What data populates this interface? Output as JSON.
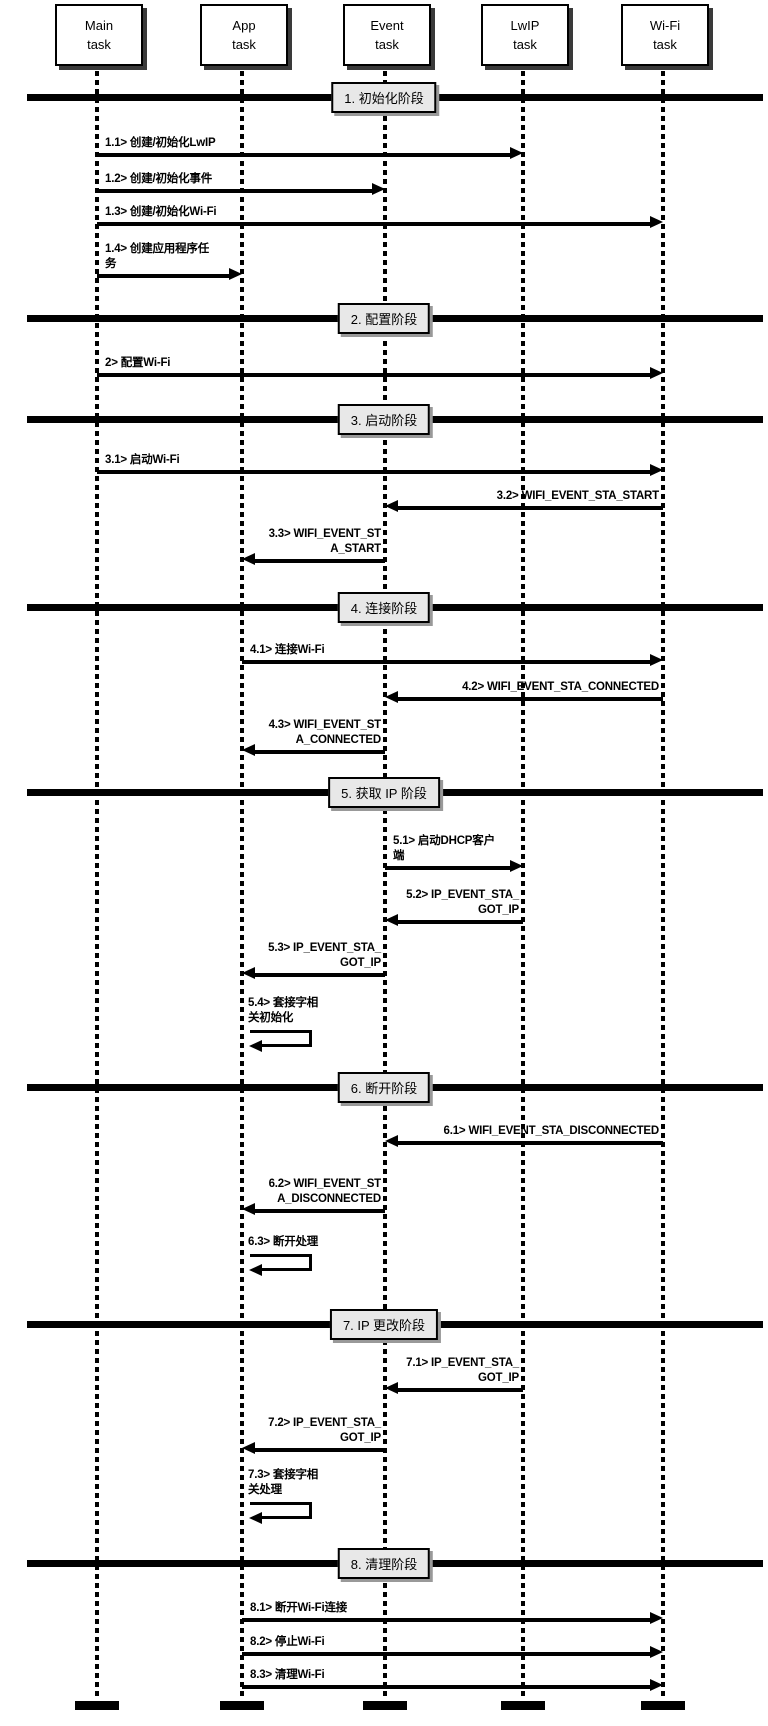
{
  "diagram": {
    "type": "sequence-diagram",
    "colors": {
      "background": "#ffffff",
      "line": "#000000",
      "divider_label_fill": "#e8e8e8",
      "box_shadow": "#3a3a3a"
    },
    "actors": [
      {
        "id": "main",
        "label": "Main\ntask",
        "x": 97
      },
      {
        "id": "app",
        "label": "App\ntask",
        "x": 242
      },
      {
        "id": "event",
        "label": "Event\ntask",
        "x": 385
      },
      {
        "id": "lwip",
        "label": "LwIP\ntask",
        "x": 523
      },
      {
        "id": "wifi",
        "label": "Wi-Fi\ntask",
        "x": 663
      }
    ],
    "phases": [
      {
        "number": 1,
        "label": "1. 初始化阶段",
        "y": 97
      },
      {
        "number": 2,
        "label": "2. 配置阶段",
        "y": 318
      },
      {
        "number": 3,
        "label": "3. 启动阶段",
        "y": 419
      },
      {
        "number": 4,
        "label": "4. 连接阶段",
        "y": 607
      },
      {
        "number": 5,
        "label": "5. 获取 IP 阶段",
        "y": 792
      },
      {
        "number": 6,
        "label": "6. 断开阶段",
        "y": 1087
      },
      {
        "number": 7,
        "label": "7. IP 更改阶段",
        "y": 1324
      },
      {
        "number": 8,
        "label": "8. 清理阶段",
        "y": 1563
      }
    ],
    "messages": [
      {
        "id": "1.1",
        "lines": [
          "1.1> 创建/初始化LwIP"
        ],
        "from": "main",
        "to": "lwip",
        "y": 155
      },
      {
        "id": "1.2",
        "lines": [
          "1.2> 创建/初始化事件"
        ],
        "from": "main",
        "to": "event",
        "y": 191
      },
      {
        "id": "1.3",
        "lines": [
          "1.3> 创建/初始化Wi-Fi"
        ],
        "from": "main",
        "to": "wifi",
        "y": 224
      },
      {
        "id": "1.4",
        "lines": [
          "1.4> 创建应用程序任",
          "务"
        ],
        "from": "main",
        "to": "app",
        "y": 276
      },
      {
        "id": "2",
        "lines": [
          "2> 配置Wi-Fi"
        ],
        "from": "main",
        "to": "wifi",
        "y": 375
      },
      {
        "id": "3.1",
        "lines": [
          "3.1> 启动Wi-Fi"
        ],
        "from": "main",
        "to": "wifi",
        "y": 472
      },
      {
        "id": "3.2",
        "lines": [
          "3.2> WIFI_EVENT_STA_START"
        ],
        "from": "wifi",
        "to": "event",
        "y": 508
      },
      {
        "id": "3.3",
        "lines": [
          "3.3> WIFI_EVENT_ST",
          "A_START"
        ],
        "from": "event",
        "to": "app",
        "y": 561
      },
      {
        "id": "4.1",
        "lines": [
          "4.1> 连接Wi-Fi"
        ],
        "from": "app",
        "to": "wifi",
        "y": 662
      },
      {
        "id": "4.2",
        "lines": [
          "4.2> WIFI_EVENT_STA_CONNECTED"
        ],
        "from": "wifi",
        "to": "event",
        "y": 699
      },
      {
        "id": "4.3",
        "lines": [
          "4.3> WIFI_EVENT_ST",
          "A_CONNECTED"
        ],
        "from": "event",
        "to": "app",
        "y": 752
      },
      {
        "id": "5.1",
        "lines": [
          "5.1> 启动DHCP客户",
          "端"
        ],
        "from": "event",
        "to": "lwip",
        "y": 868
      },
      {
        "id": "5.2",
        "lines": [
          "5.2> IP_EVENT_STA_",
          "GOT_IP"
        ],
        "from": "lwip",
        "to": "event",
        "y": 922
      },
      {
        "id": "5.3",
        "lines": [
          "5.3> IP_EVENT_STA_",
          "GOT_IP"
        ],
        "from": "event",
        "to": "app",
        "y": 975
      },
      {
        "id": "5.4",
        "lines": [
          "5.4> 套接字相",
          "关初始化"
        ],
        "from": "app",
        "to": "app",
        "self": true,
        "y": 1030
      },
      {
        "id": "6.1",
        "lines": [
          "6.1> WIFI_EVENT_STA_DISCONNECTED"
        ],
        "from": "wifi",
        "to": "event",
        "y": 1143
      },
      {
        "id": "6.2",
        "lines": [
          "6.2> WIFI_EVENT_ST",
          "A_DISCONNECTED"
        ],
        "from": "event",
        "to": "app",
        "y": 1211
      },
      {
        "id": "6.3",
        "lines": [
          "6.3> 断开处理"
        ],
        "from": "app",
        "to": "app",
        "self": true,
        "y": 1254
      },
      {
        "id": "7.1",
        "lines": [
          "7.1> IP_EVENT_STA_",
          "GOT_IP"
        ],
        "from": "lwip",
        "to": "event",
        "y": 1390
      },
      {
        "id": "7.2",
        "lines": [
          "7.2> IP_EVENT_STA_",
          "GOT_IP"
        ],
        "from": "event",
        "to": "app",
        "y": 1450
      },
      {
        "id": "7.3",
        "lines": [
          "7.3> 套接字相",
          "关处理"
        ],
        "from": "app",
        "to": "app",
        "self": true,
        "y": 1502
      },
      {
        "id": "8.1",
        "lines": [
          "8.1> 断开Wi-Fi连接"
        ],
        "from": "app",
        "to": "wifi",
        "y": 1620
      },
      {
        "id": "8.2",
        "lines": [
          "8.2> 停止Wi-Fi"
        ],
        "from": "app",
        "to": "wifi",
        "y": 1654
      },
      {
        "id": "8.3",
        "lines": [
          "8.3> 清理Wi-Fi"
        ],
        "from": "app",
        "to": "wifi",
        "y": 1687
      }
    ],
    "layout": {
      "lifeline_top": 62,
      "lifeline_bottom": 1700,
      "endcap_y": 1701,
      "divider_center_x": 384
    }
  }
}
